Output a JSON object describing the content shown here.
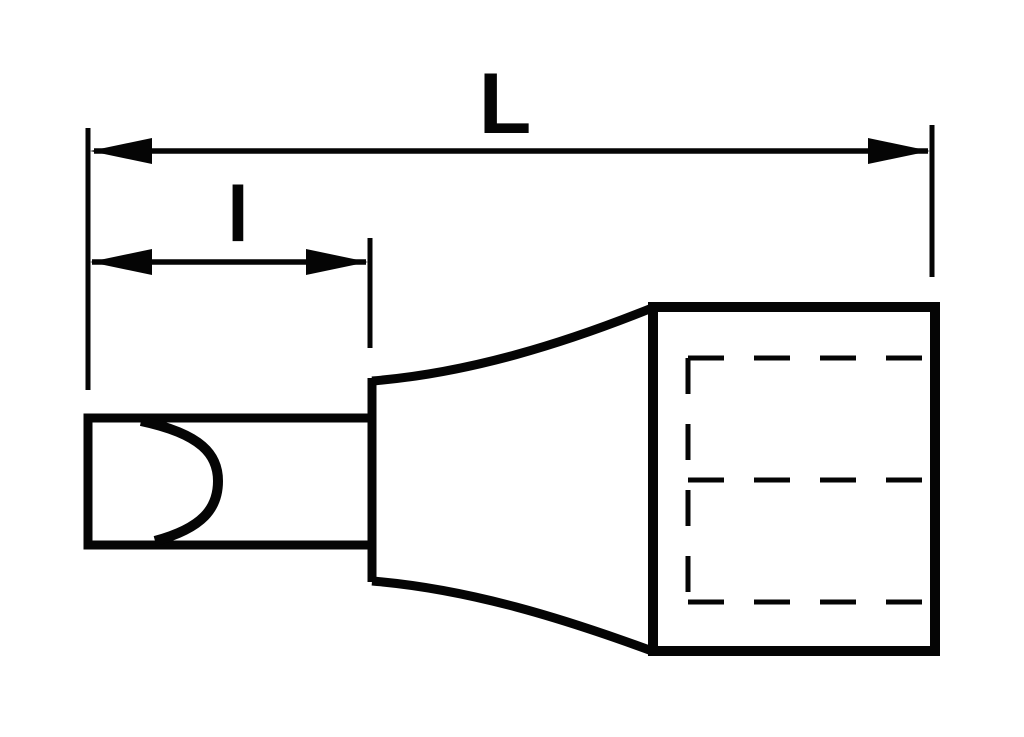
{
  "diagram": {
    "type": "technical-dimension-drawing",
    "subject": "slotted screwdriver bit socket, side view",
    "background_color": "#ffffff",
    "line_color": "#050505",
    "dimensions": {
      "overall_length": {
        "label": "L"
      },
      "bit_length": {
        "label": "l"
      }
    },
    "features": [
      "slotted-blade-tip-curve",
      "bit-shank",
      "tapered-neck",
      "socket-body",
      "square-drive-hidden-outline"
    ]
  }
}
